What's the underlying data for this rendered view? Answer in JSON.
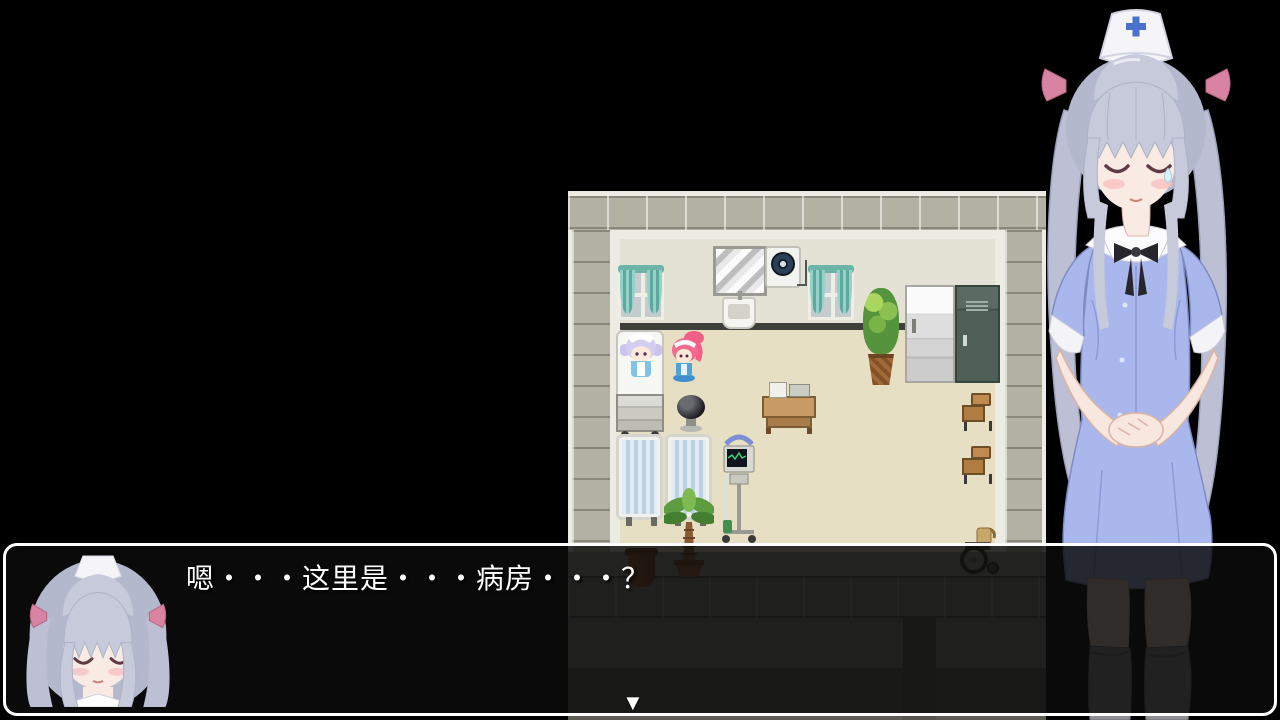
{
  "app": {
    "type": "rpg-game-screen",
    "background": "#000000"
  },
  "dialogue": {
    "speaker_portrait": "nurse-face",
    "text": "嗯・・・这里是・・・病房・・・？",
    "continue_indicator": "▼",
    "text_color": "#ffffff",
    "box_background": "rgba(12,12,12,0.84)",
    "box_border_color": "#ffffff"
  },
  "game_map": {
    "scene": "hospital-ward-room",
    "objects": [
      "curtained-window",
      "wall-mirror",
      "ventilation-fan",
      "wash-sink",
      "curtained-window",
      "tall-potted-plant",
      "refrigerator",
      "storage-locker",
      "hospital-bed",
      "silver-haired-maid-sitting",
      "pink-haired-maid-standing",
      "black-stool",
      "medical-supply-table",
      "school-chair",
      "school-chair",
      "privacy-screen",
      "privacy-screen",
      "palm-plant",
      "medical-monitor-cart",
      "clay-pot",
      "wheelchair"
    ],
    "palette": {
      "floor": "#e7dfc3",
      "interior_wall": "#e4e2d4",
      "tile_wall": "#b2b1a3",
      "curtain": "#7cc4bc",
      "baseboard": "#3f3f3c"
    }
  },
  "characters": {
    "nurse_bust": {
      "pose": "standing-hands-clasped-eyes-closed",
      "hair_color": "#c7cadb",
      "dress_color": "#a9b7ec",
      "cap_color": "#f5f5f9",
      "cap_cross_color": "#4a72cc",
      "ribbon_color": "#d983a2",
      "stocking_color": "#8f8f93"
    }
  }
}
